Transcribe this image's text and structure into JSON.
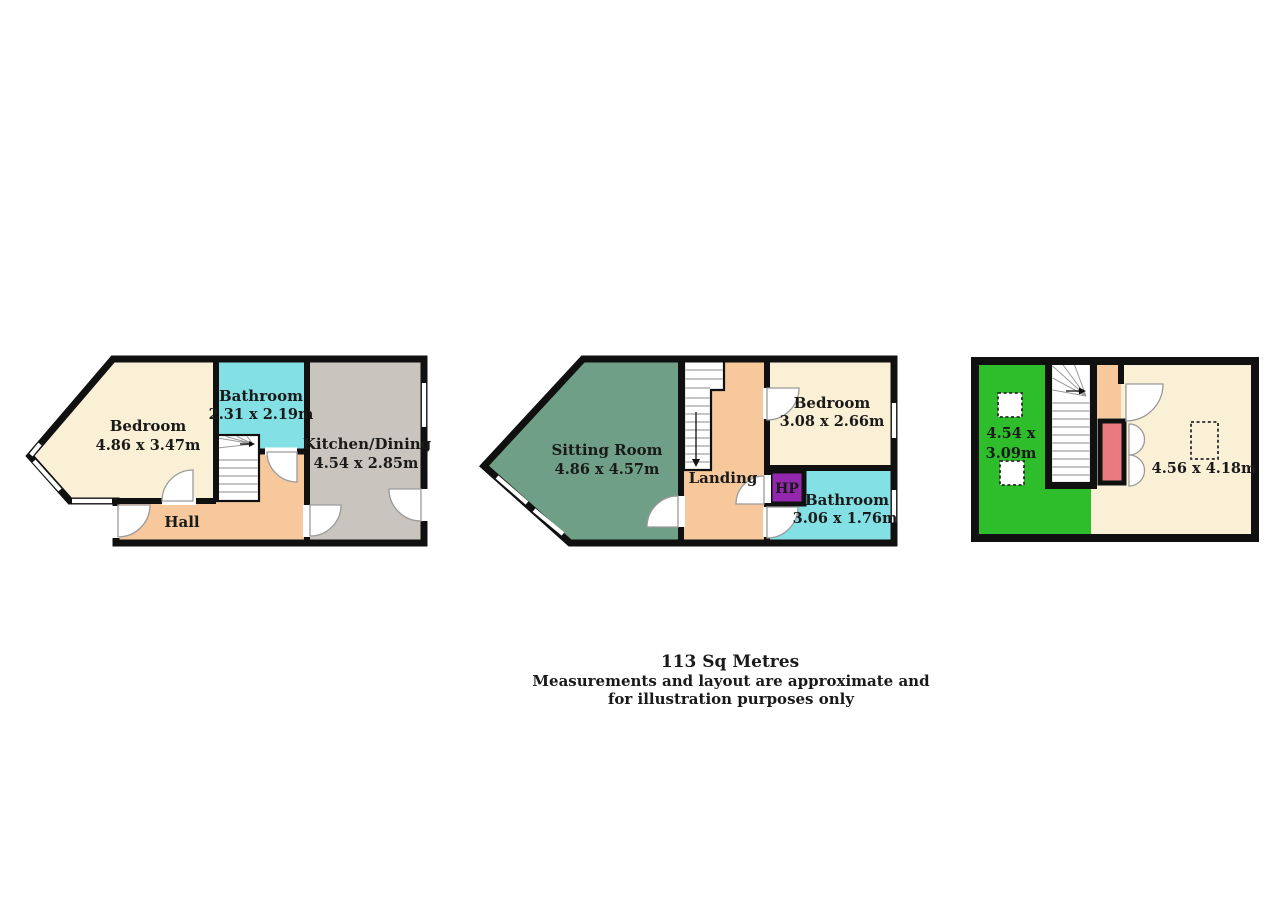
{
  "colors": {
    "wall": "#101010",
    "cream": "#faf0d5",
    "cyan": "#83e1e6",
    "gray": "#c9c5be",
    "peach": "#f6c89c",
    "sage": "#6f9f86",
    "bright_green": "#2ebe2b",
    "purple": "#9327ad",
    "red": "#e97b80",
    "text": "#1a1a1a"
  },
  "plans": [
    {
      "title": "ground-floor",
      "rooms": {
        "bedroom": {
          "label": "Bedroom",
          "dims": "4.86 x 3.47m"
        },
        "bathroom": {
          "label": "Bathroom",
          "dims": "2.31 x 2.19m"
        },
        "kitchen": {
          "label": "Kitchen/Dining",
          "dims": "4.54 x 2.85m"
        },
        "hall": {
          "label": "Hall"
        }
      }
    },
    {
      "title": "first-floor",
      "rooms": {
        "sitting": {
          "label": "Sitting Room",
          "dims": "4.86 x 4.57m"
        },
        "landing": {
          "label": "Landing"
        },
        "bedroom": {
          "label": "Bedroom",
          "dims": "3.08 x 2.66m"
        },
        "hp": {
          "label": "HP"
        },
        "bathroom": {
          "label": "Bathroom",
          "dims": "3.06 x 1.76m"
        }
      }
    },
    {
      "title": "attic-floor",
      "rooms": {
        "left_room": {
          "dims_line1": "4.54 x",
          "dims_line2": "3.09m"
        },
        "right_room": {
          "dims": "4.56 x 4.18m"
        }
      }
    }
  ],
  "footer": {
    "area": "113 Sq Metres",
    "disclaimer_line1": "Measurements and layout are approximate and",
    "disclaimer_line2": "for illustration purposes only"
  }
}
